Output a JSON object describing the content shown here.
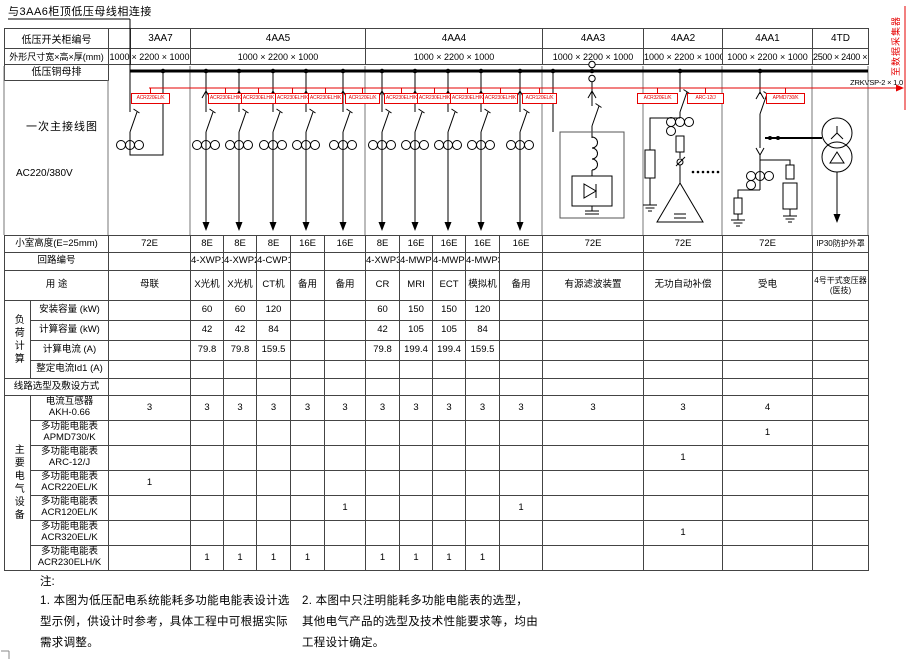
{
  "colors": {
    "accent_red": "#e60000"
  },
  "connect_note": "与3AA6柜顶低压母线相连接",
  "collector": {
    "label": "至数据采集器",
    "wire": "ZRKVSP-2 × 1.0"
  },
  "header": {
    "row1_label": "低压开关柜编号",
    "row2_label": "外形尺寸宽×高×厚(mm)",
    "row3_label": "低压铜母排",
    "size_prefix": "1000",
    "cabinets": [
      {
        "id": "3AA7",
        "size": "× 2200 × 1000"
      },
      {
        "id": "4AA5",
        "size": "1000 × 2200 × 1000"
      },
      {
        "id": "4AA4",
        "size": "1000 × 2200 × 1000"
      },
      {
        "id": "4AA3",
        "size": "1000 × 2200 × 1000"
      },
      {
        "id": "4AA2",
        "size": "1000 × 2200 × 1000"
      },
      {
        "id": "4AA1",
        "size": "1000 × 2200 × 1000"
      },
      {
        "id": "4TD",
        "size": "2500 × 2400 × 1500"
      }
    ]
  },
  "diagram": {
    "label": "一次主接线图",
    "voltage": "AC220/380V",
    "meters": [
      {
        "x": 131,
        "w": 37,
        "label": "ACR220EL/K"
      },
      {
        "x": 208,
        "w": 33,
        "label": "ACR230ELH/K"
      },
      {
        "x": 241,
        "w": 33,
        "label": "ACR230ELH/K"
      },
      {
        "x": 275,
        "w": 33,
        "label": "ACR230ELH/K"
      },
      {
        "x": 308,
        "w": 33,
        "label": "ACR230ELH/K"
      },
      {
        "x": 345,
        "w": 33,
        "label": "ACR120EL/K"
      },
      {
        "x": 384,
        "w": 33,
        "label": "ACR230ELH/K"
      },
      {
        "x": 417,
        "w": 33,
        "label": "ACR230ELH/K"
      },
      {
        "x": 450,
        "w": 33,
        "label": "ACR230ELH/K"
      },
      {
        "x": 483,
        "w": 33,
        "label": "ACR230ELH/K"
      },
      {
        "x": 522,
        "w": 33,
        "label": "ACR120EL/K"
      },
      {
        "x": 637,
        "w": 39,
        "label": "ACR320EL/K"
      },
      {
        "x": 687,
        "w": 35,
        "label": "ARC-12/J"
      },
      {
        "x": 766,
        "w": 37,
        "label": "APMD730/K"
      }
    ]
  },
  "table": {
    "groups": [
      {
        "start": 3,
        "span": 4,
        "text": "负荷计算"
      },
      {
        "start": 8,
        "span": 7,
        "text": "主要电气设备"
      }
    ],
    "row_heights": [
      17,
      18,
      30,
      20,
      20,
      20,
      18,
      17,
      25,
      25,
      25,
      25,
      25,
      25,
      25
    ],
    "rows": [
      {
        "label": "小室高度(E=25mm)",
        "cells": [
          "72E",
          "8E",
          "8E",
          "8E",
          "16E",
          "16E",
          "8E",
          "16E",
          "16E",
          "16E",
          "16E",
          "72E",
          "72E",
          "72E",
          "IP30防护外罩"
        ]
      },
      {
        "label": "回路编号",
        "cells": [
          "",
          "4-XWP1",
          "4-XWP2",
          "4-CWP1",
          "",
          "",
          "4-XWP3",
          "4-MWP1",
          "4-MWP2",
          "4-MWP3",
          "",
          "",
          "",
          "",
          ""
        ]
      },
      {
        "label": "用  途",
        "cells": [
          "母联",
          "X光机",
          "X光机",
          "CT机",
          "备用",
          "备用",
          "CR",
          "MRI",
          "ECT",
          "模拟机",
          "备用",
          "有源滤波装置",
          "无功自动补偿",
          "受电",
          "4号干式变压器\n(医技)"
        ]
      },
      {
        "label": "安装容量 (kW)",
        "cells": [
          "",
          "60",
          "60",
          "120",
          "",
          "",
          "60",
          "150",
          "150",
          "120",
          "",
          "",
          "",
          "",
          ""
        ]
      },
      {
        "label": "计算容量 (kW)",
        "cells": [
          "",
          "42",
          "42",
          "84",
          "",
          "",
          "42",
          "105",
          "105",
          "84",
          "",
          "",
          "",
          "",
          ""
        ]
      },
      {
        "label": "计算电流 (A)",
        "cells": [
          "",
          "79.8",
          "79.8",
          "159.5",
          "",
          "",
          "79.8",
          "199.4",
          "199.4",
          "159.5",
          "",
          "",
          "",
          "",
          ""
        ]
      },
      {
        "label": "整定电流Id1 (A)",
        "cells": [
          "",
          "",
          "",
          "",
          "",
          "",
          "",
          "",
          "",
          "",
          "",
          "",
          "",
          "",
          ""
        ]
      },
      {
        "label": "线路选型及敷设方式",
        "cells": [
          "",
          "",
          "",
          "",
          "",
          "",
          "",
          "",
          "",
          "",
          "",
          "",
          "",
          "",
          ""
        ]
      },
      {
        "label": "电流互感器\nAKH-0.66",
        "cells": [
          "3",
          "3",
          "3",
          "3",
          "3",
          "3",
          "3",
          "3",
          "3",
          "3",
          "3",
          "3",
          "3",
          "4",
          ""
        ]
      },
      {
        "label": "多功能电能表\nAPMD730/K",
        "cells": [
          "",
          "",
          "",
          "",
          "",
          "",
          "",
          "",
          "",
          "",
          "",
          "",
          "",
          "1",
          ""
        ]
      },
      {
        "label": "多功能电能表\nARC-12/J",
        "cells": [
          "",
          "",
          "",
          "",
          "",
          "",
          "",
          "",
          "",
          "",
          "",
          "",
          "1",
          "",
          ""
        ]
      },
      {
        "label": "多功能电能表\nACR220EL/K",
        "cells": [
          "1",
          "",
          "",
          "",
          "",
          "",
          "",
          "",
          "",
          "",
          "",
          "",
          "",
          "",
          ""
        ]
      },
      {
        "label": "多功能电能表\nACR120EL/K",
        "cells": [
          "",
          "",
          "",
          "",
          "",
          "1",
          "",
          "",
          "",
          "",
          "1",
          "",
          "",
          "",
          ""
        ]
      },
      {
        "label": "多功能电能表\nACR320EL/K",
        "cells": [
          "",
          "",
          "",
          "",
          "",
          "",
          "",
          "",
          "",
          "",
          "",
          "",
          "1",
          "",
          ""
        ]
      },
      {
        "label": "多功能电能表\nACR230ELH/K",
        "cells": [
          "",
          "1",
          "1",
          "1",
          "1",
          "",
          "1",
          "1",
          "1",
          "1",
          "",
          "",
          "",
          "",
          ""
        ]
      }
    ]
  },
  "notes": {
    "heading": "注:",
    "n1": "1. 本图为低压配电系统能耗多功能电能表设计选型示例，供设计时参考，具体工程中可根据实际需求调整。",
    "n2": "2. 本图中只注明能耗多功能电能表的选型，其他电气产品的选型及技术性能要求等，均由工程设计确定。"
  }
}
